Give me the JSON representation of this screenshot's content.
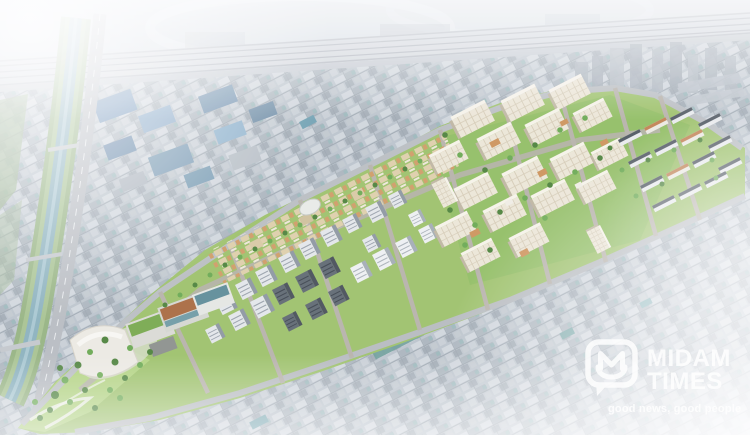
{
  "watermark": {
    "logo_icon": "speech-bubble-m-icon",
    "name_line1": "MIDAM",
    "name_line2": "TIMES",
    "tagline": "good news, good people",
    "text_color": "#ffffff"
  },
  "scene": {
    "type": "aerial-rendering",
    "subject": "redevelopment-master-plan-birdseye",
    "palette": {
      "city_base": "#aeb8c0",
      "haze_white": "#ffffff",
      "development_green": "#9cc168",
      "courtyard_green": "#8cba5e",
      "tree_green_dark": "#4a8038",
      "tree_green_mid": "#68a84f",
      "tree_green_light": "#82bb5e",
      "apartment_cream": "#ece6d6",
      "stream_water": "#6f9fae",
      "riverbank_green": "#7da25f",
      "road_gray": "#a9aeb3",
      "railway_gray": "#c7ccd2",
      "industrial_blue_roof": "#4e7aa8",
      "market_teal_roof": "#4f9490",
      "orange_roof": "#cd9258",
      "landmark_roof_brown": "#a8683c",
      "landmark_roof_green": "#76a84a"
    },
    "elements": [
      "railway-corridor",
      "north-rail-yards",
      "stream",
      "riverside-road",
      "existing-city-fabric",
      "industrial-blue-roofs",
      "market-teal-roofs",
      "distant-towers",
      "redevelopment-district",
      "district-streets",
      "apartment-towers-cluster",
      "midrise-blocks-cluster",
      "lowrise-strip",
      "townhouse-rows",
      "landmark-complex",
      "central-park",
      "haze-overlay",
      "watermark"
    ]
  }
}
